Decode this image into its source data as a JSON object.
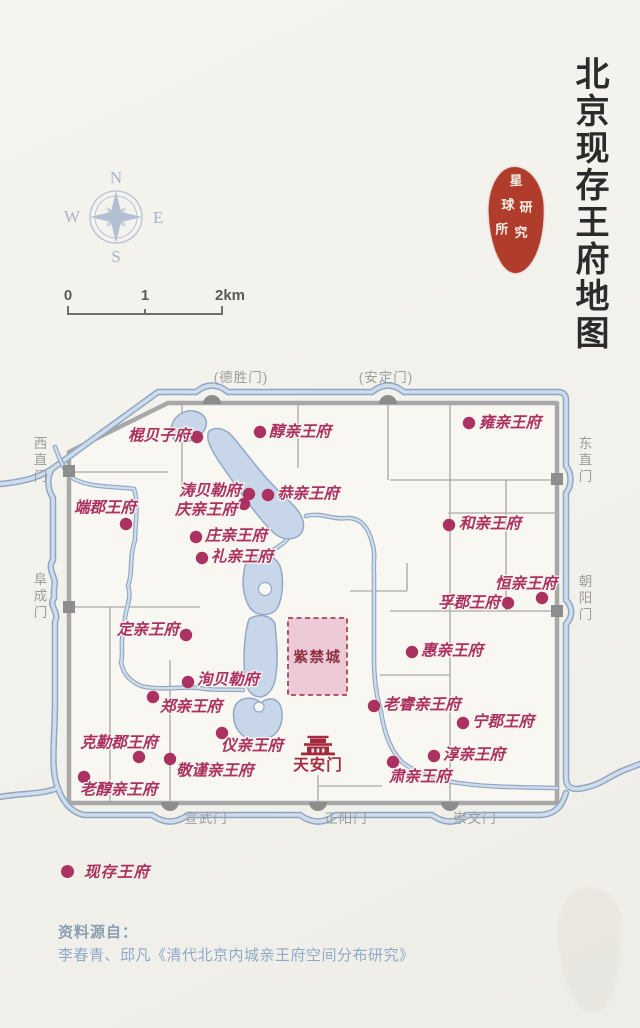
{
  "title": {
    "text": "北京现存王府地图"
  },
  "seal": {
    "chars": [
      "星",
      "球",
      "研",
      "究",
      "所"
    ]
  },
  "compass": {
    "n": "N",
    "e": "E",
    "s": "S",
    "w": "W"
  },
  "scale_bar": {
    "labels": [
      "0",
      "1",
      "2km"
    ]
  },
  "legend": {
    "dot_label": "现存王府"
  },
  "source": {
    "line1": "资料源自：",
    "line2": "李春青、邱凡《清代北京内城亲王府空间分布研究》"
  },
  "colors": {
    "accent_crimson": "#ac3260",
    "forbidden_fill": "#eccbd7",
    "forbidden_border": "#ab4258",
    "forbidden_label": "#8d3040",
    "tiananmen_red": "#a22a3c",
    "wall_gray": "#a8a8a8",
    "gate_gray": "#8d8d8d",
    "gate_label_gray": "#9d9d9d",
    "water_edge": "#8fa6c2",
    "water_fill": "#cfdceb",
    "seal_red": "#b03d2c",
    "paper": "#f2f1ec"
  },
  "map": {
    "forbidden_city": {
      "label": "紫禁城",
      "x": 288,
      "y": 618,
      "w": 59,
      "h": 77
    },
    "tiananmen": {
      "label": "天安门",
      "x": 318,
      "y": 750,
      "lx": 318,
      "ly": 770
    },
    "gates": [
      {
        "id": "deshengmen",
        "label": "(德胜门)",
        "side": "top",
        "x": 212,
        "y": 403,
        "lx": 241,
        "ly": 382
      },
      {
        "id": "andingmen",
        "label": "(安定门)",
        "side": "top",
        "x": 388,
        "y": 403,
        "lx": 386,
        "ly": 382
      },
      {
        "id": "xizhimen",
        "label": "西直门",
        "side": "left",
        "x": 69,
        "y": 471,
        "lx": 39,
        "ly": 461
      },
      {
        "id": "fuchengmen",
        "label": "阜成门",
        "side": "left",
        "x": 69,
        "y": 607,
        "lx": 39,
        "ly": 597
      },
      {
        "id": "dongzhimen",
        "label": "东直门",
        "side": "right",
        "x": 557,
        "y": 479,
        "lx": 584,
        "ly": 461
      },
      {
        "id": "chaoyangmen",
        "label": "朝阳门",
        "side": "right",
        "x": 557,
        "y": 611,
        "lx": 584,
        "ly": 599
      },
      {
        "id": "xuanwumen",
        "label": "宣武门",
        "side": "bottom",
        "x": 170,
        "y": 803,
        "lx": 206,
        "ly": 823
      },
      {
        "id": "zhengyangmen",
        "label": "正阳门",
        "side": "bottom",
        "x": 318,
        "y": 803,
        "lx": 346,
        "ly": 823
      },
      {
        "id": "chongwenmen",
        "label": "崇文门",
        "side": "bottom",
        "x": 450,
        "y": 803,
        "lx": 475,
        "ly": 823
      }
    ],
    "mansions": [
      {
        "id": "gun-beizi-fu",
        "name": "棍贝子府",
        "dot": [
          197,
          437
        ],
        "label": [
          190,
          436
        ],
        "align": "end"
      },
      {
        "id": "chun-qin-wang-fu",
        "name": "醇亲王府",
        "dot": [
          260,
          432
        ],
        "label": [
          269,
          432
        ],
        "align": "start"
      },
      {
        "id": "yong-qin-wang-fu",
        "name": "雍亲王府",
        "dot": [
          469,
          423
        ],
        "label": [
          479,
          423
        ],
        "align": "start"
      },
      {
        "id": "tao-beile-fu",
        "name": "涛贝勒府",
        "dot": [
          249,
          494
        ],
        "label": [
          241,
          491
        ],
        "align": "end"
      },
      {
        "id": "gong-qin-wang-fu",
        "name": "恭亲王府",
        "dot": [
          268,
          495
        ],
        "label": [
          277,
          494
        ],
        "align": "start"
      },
      {
        "id": "qing-qin-wang-fu",
        "name": "庆亲王府",
        "dot": [
          244,
          504
        ],
        "label": [
          237,
          510
        ],
        "align": "end"
      },
      {
        "id": "duan-jun-wang-fu",
        "name": "端郡王府",
        "dot": [
          126,
          524
        ],
        "label": [
          105,
          508
        ],
        "align": "middle"
      },
      {
        "id": "zhuang-qin-wang-fu",
        "name": "庄亲王府",
        "dot": [
          196,
          537
        ],
        "label": [
          205,
          536
        ],
        "align": "start"
      },
      {
        "id": "li-qin-wang-fu",
        "name": "礼亲王府",
        "dot": [
          202,
          558
        ],
        "label": [
          211,
          557
        ],
        "align": "start"
      },
      {
        "id": "he-qin-wang-fu",
        "name": "和亲王府",
        "dot": [
          449,
          525
        ],
        "label": [
          459,
          524
        ],
        "align": "start"
      },
      {
        "id": "heng-qin-wang-fu",
        "name": "恒亲王府",
        "dot": [
          542,
          598
        ],
        "label": [
          526,
          584
        ],
        "align": "middle"
      },
      {
        "id": "fu-jun-wang-fu",
        "name": "孚郡王府",
        "dot": [
          508,
          603
        ],
        "label": [
          500,
          603
        ],
        "align": "end"
      },
      {
        "id": "ding-qin-wang-fu",
        "name": "定亲王府",
        "dot": [
          186,
          635
        ],
        "label": [
          179,
          630
        ],
        "align": "end"
      },
      {
        "id": "hui-qin-wang-fu",
        "name": "惠亲王府",
        "dot": [
          412,
          652
        ],
        "label": [
          421,
          651
        ],
        "align": "start"
      },
      {
        "id": "xun-beile-fu",
        "name": "洵贝勒府",
        "dot": [
          188,
          682
        ],
        "label": [
          197,
          680
        ],
        "align": "start"
      },
      {
        "id": "zheng-qin-wang-fu",
        "name": "郑亲王府",
        "dot": [
          153,
          697
        ],
        "label": [
          160,
          707
        ],
        "align": "start"
      },
      {
        "id": "lao-rui-qin-wang-fu",
        "name": "老睿亲王府",
        "dot": [
          374,
          706
        ],
        "label": [
          383,
          705
        ],
        "align": "start"
      },
      {
        "id": "ning-jun-wang-fu",
        "name": "宁郡王府",
        "dot": [
          463,
          723
        ],
        "label": [
          472,
          722
        ],
        "align": "start"
      },
      {
        "id": "ke-qin-jun-wang-fu",
        "name": "克勤郡王府",
        "dot": [
          139,
          757
        ],
        "label": [
          119,
          743
        ],
        "align": "middle"
      },
      {
        "id": "chun2-qin-wang-fu",
        "name": "淳亲王府",
        "dot": [
          434,
          756
        ],
        "label": [
          443,
          755
        ],
        "align": "start"
      },
      {
        "id": "yi-qin-wang-fu",
        "name": "仪亲王府",
        "dot": [
          222,
          733
        ],
        "label": [
          221,
          746
        ],
        "align": "start"
      },
      {
        "id": "jing-jin-qin-wang-fu",
        "name": "敬谨亲王府",
        "dot": [
          170,
          759
        ],
        "label": [
          176,
          771
        ],
        "align": "start"
      },
      {
        "id": "su-qin-wang-fu",
        "name": "肃亲王府",
        "dot": [
          393,
          762
        ],
        "label": [
          420,
          777
        ],
        "align": "middle"
      },
      {
        "id": "lao-chun-qin-wang-fu",
        "name": "老醇亲王府",
        "dot": [
          84,
          777
        ],
        "label": [
          80,
          790
        ],
        "align": "start"
      }
    ]
  }
}
